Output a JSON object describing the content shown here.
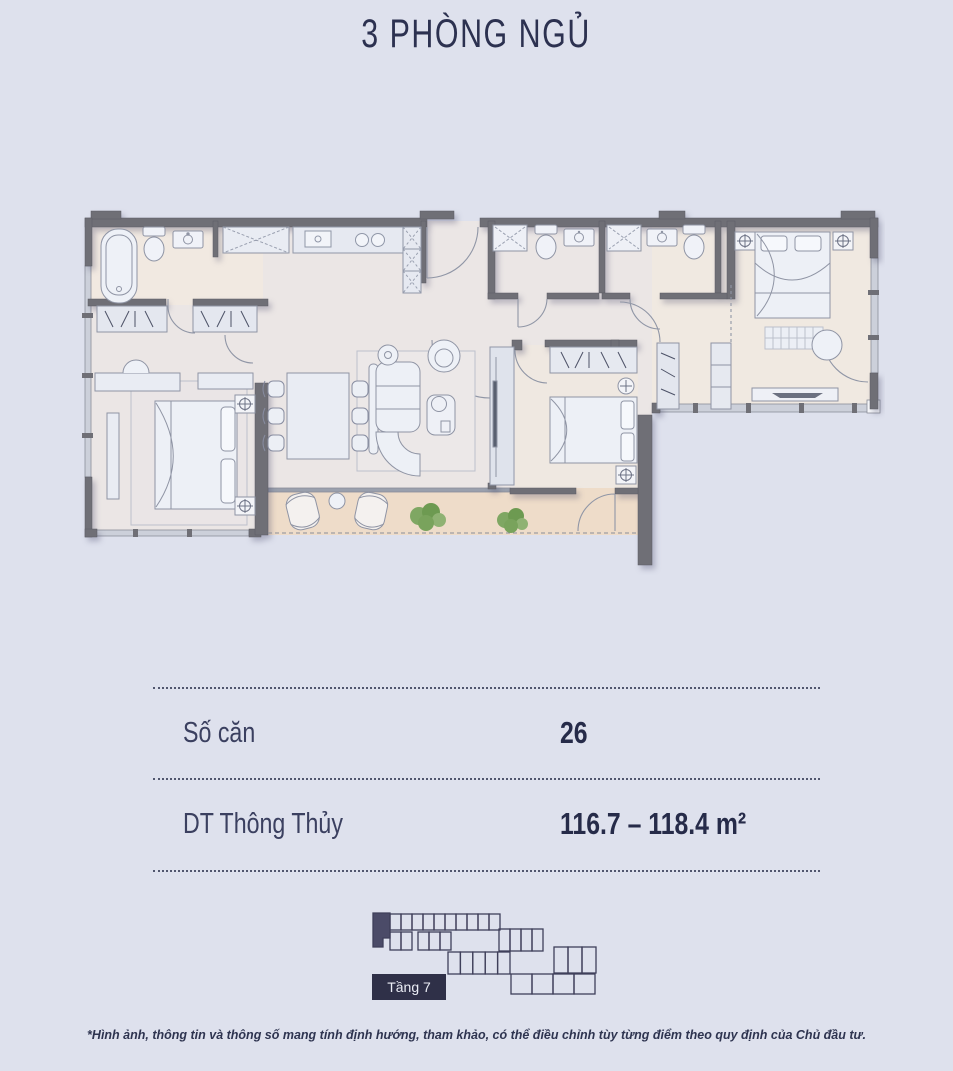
{
  "page": {
    "title": "3 PHÒNG NGỦ"
  },
  "specs": {
    "rows": [
      {
        "label": "Số căn",
        "value": "26"
      },
      {
        "label": "DT Thông Thủy",
        "value": "116.7 – 118.4 m²"
      }
    ]
  },
  "key_plan": {
    "floor_label": "Tầng 7"
  },
  "disclaimer": "*Hình ảnh, thông tin và thông số mang tính định hướng, tham khảo, có thể điều chỉnh tùy từng điểm theo quy định của Chủ đầu tư.",
  "colors": {
    "background": "#dee1ed",
    "accent_navy": "#2c3150",
    "wall": "#6f6f76",
    "room_warm": "#ebe6e5",
    "room_beige": "#f0e9e1",
    "balcony": "#eedcc9",
    "plant_green": "#6d9a51",
    "highlight_unit": "#4b4b68"
  }
}
